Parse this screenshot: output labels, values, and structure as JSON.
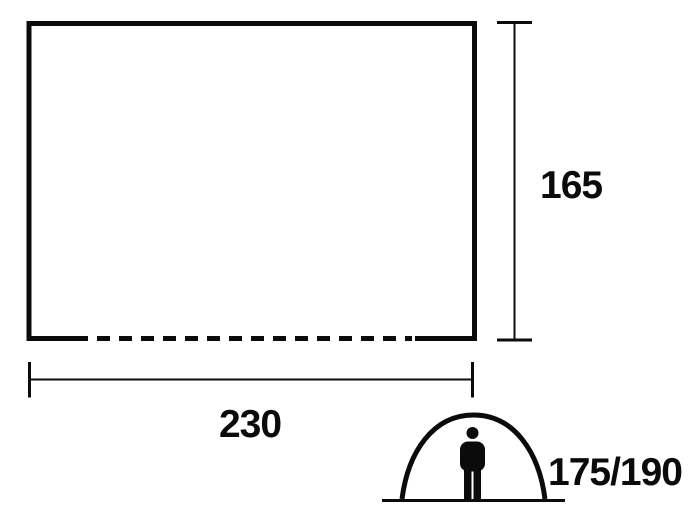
{
  "diagram": {
    "type": "tent-floor-plan-dimension-drawing",
    "colors": {
      "ink": "#0b0b0b",
      "background": "#ffffff"
    },
    "floor_plan": {
      "width_label": "230",
      "depth_label": "165",
      "open_side": "bottom-dashed"
    },
    "tent": {
      "person_height_label": "175/190"
    },
    "icons": {
      "tent": "tent-dome-icon",
      "person": "standing-person-icon"
    }
  }
}
